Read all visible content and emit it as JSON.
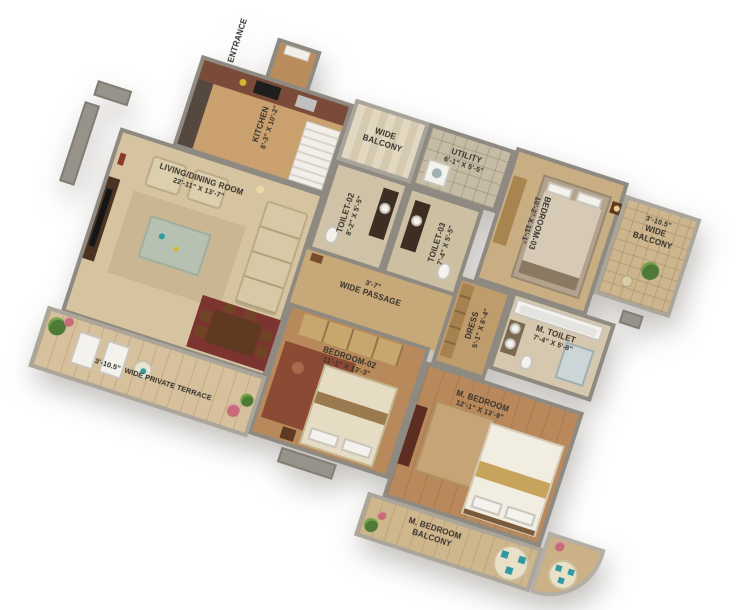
{
  "scene": {
    "type": "3d-isometric-apartment-floor-plan",
    "background": "#ffffff"
  },
  "palette": {
    "wall_gray": "#8f8a81",
    "floor_marble_beige": "#d6c3a0",
    "floor_wood": "#b8895a",
    "counter_maroon": "#7b4b39",
    "rug_maroon": "#8a4a34",
    "dining_rug_maroon": "#7c3431",
    "accent_teal": "#2f9aa3",
    "plant_green": "#4d7a36",
    "flower_pink": "#c76a7a",
    "label_text": "#35312b"
  },
  "rooms": {
    "entrance": {
      "label": "ENTRANCE"
    },
    "kitchen": {
      "label": "KITCHEN",
      "dims": "8'-3\" X 10'-2\""
    },
    "wide_balcony": {
      "label": "WIDE BALCONY"
    },
    "utility": {
      "label": "UTILITY",
      "dims": "6'-1\" X 5'-5\""
    },
    "toilet_02": {
      "label": "TOILET-02",
      "dims": "8'-2\" X 5'-5\""
    },
    "toilet_03": {
      "label": "TOILET-03",
      "dims": "7'-4\" X 5'-5\""
    },
    "bedroom_03": {
      "label": "BEDROOM-03",
      "dims": "10'-2\" X 11'-1\""
    },
    "balcony_right": {
      "label": "WIDE BALCONY",
      "dims": "3'-10.5\""
    },
    "living_dining": {
      "label": "LIVING/DINING ROOM",
      "dims": "22'-11\" X 13'-7\""
    },
    "passage": {
      "label": "WIDE PASSAGE",
      "dims": "3'-7\""
    },
    "bedroom_02": {
      "label": "BEDROOM-02",
      "dims": "11'-1\" X 13'-3\""
    },
    "dress": {
      "label": "DRESS",
      "dims": "5'-1\" X 6'-4\""
    },
    "m_toilet": {
      "label": "M. TOILET",
      "dims": "7'-4\" X 5'-8\""
    },
    "m_bedroom": {
      "label": "M. BEDROOM",
      "dims": "12'-1\" X 13'-9\""
    },
    "terrace": {
      "label": "WIDE PRIVATE TERRACE",
      "dims": "3'-10.5\""
    },
    "m_bedroom_balcony": {
      "label": "M. BEDROOM BALCONY"
    }
  }
}
